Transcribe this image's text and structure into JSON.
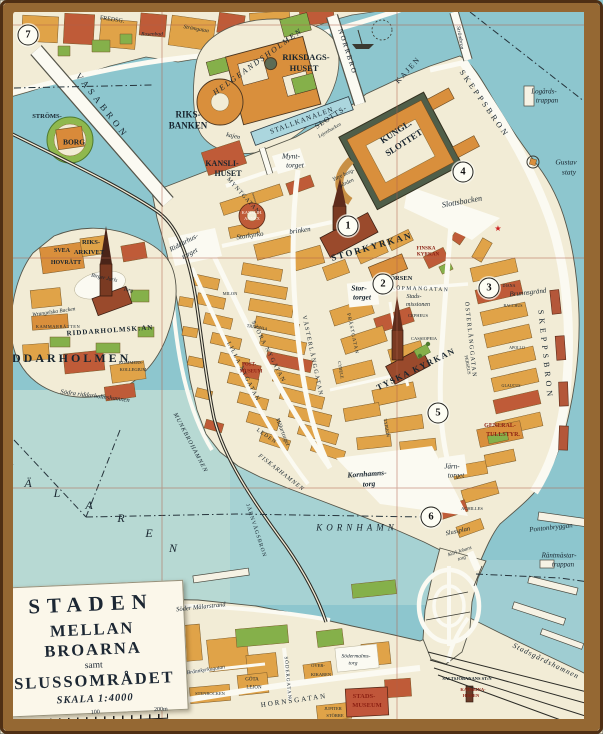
{
  "meta": {
    "map_name": "Staden mellan broarna (Gamla stan, Stockholm) pictorial map"
  },
  "palette": {
    "water": "#8dc6ce",
    "water_light": "#b7d9d3",
    "land": "#f2ecd6",
    "block_orange": "#e0a348",
    "block_orange2": "#d98f3c",
    "block_red": "#bf5b38",
    "church_red": "#9a4a2c",
    "park_green": "#85b04a",
    "roof_dark": "#5c6b55",
    "frame_brown": "#956833",
    "grid_red": "#b0614a",
    "ink": "#17242e",
    "label_red": "#8b1f12"
  },
  "title_block": {
    "line1": "STADEN",
    "line2": "MELLAN BROARNA",
    "line3": "samt",
    "line4": "SLUSSOMRÅDET",
    "scale_label": "SKALA 1:4000",
    "tick_mid": "100",
    "tick_end": "200m"
  },
  "markers": [
    {
      "n": "1",
      "x": 348,
      "y": 226
    },
    {
      "n": "2",
      "x": 383,
      "y": 284
    },
    {
      "n": "3",
      "x": 489,
      "y": 288
    },
    {
      "n": "4",
      "x": 463,
      "y": 172
    },
    {
      "n": "5",
      "x": 438,
      "y": 413
    },
    {
      "n": "6",
      "x": 431,
      "y": 517
    },
    {
      "n": "7",
      "x": 28,
      "y": 35
    }
  ],
  "labels": [
    {
      "t": "FREDSG.",
      "x": 112,
      "y": 20,
      "s": 6,
      "r": 8
    },
    {
      "t": "Rosenbad",
      "x": 152,
      "y": 35,
      "s": 5.5,
      "i": 1
    },
    {
      "t": "Strömgatan",
      "x": 196,
      "y": 30,
      "s": 5.5,
      "i": 1,
      "r": 10
    },
    {
      "t": "VASABRON",
      "x": 102,
      "y": 106,
      "s": 9,
      "r": 52,
      "ls": 4
    },
    {
      "t": "STRÖMS-",
      "x": 47,
      "y": 117,
      "s": 6.5,
      "w": 1
    },
    {
      "t": "BORG",
      "x": 74,
      "y": 142,
      "s": 7.5,
      "w": 1
    },
    {
      "t": "HELGEANDSHOLMEN",
      "x": 258,
      "y": 62,
      "s": 8,
      "r": -36,
      "ls": 2,
      "i": 1
    },
    {
      "t": "RIKSDAGS-",
      "x": 306,
      "y": 57,
      "s": 8.5,
      "w": 1
    },
    {
      "t": "HUSET",
      "x": 304,
      "y": 68,
      "s": 8.5,
      "w": 1
    },
    {
      "t": "RIKS-",
      "x": 188,
      "y": 115,
      "s": 9,
      "w": 1
    },
    {
      "t": "BANKEN",
      "x": 188,
      "y": 126,
      "s": 9,
      "w": 1
    },
    {
      "t": "kajen",
      "x": 233,
      "y": 137,
      "s": 6.5,
      "i": 1,
      "r": 12
    },
    {
      "t": "NORRBRO",
      "x": 347,
      "y": 52,
      "s": 7,
      "r": 72,
      "ls": 2
    },
    {
      "t": "Strömbron",
      "x": 459,
      "y": 38,
      "s": 5.5,
      "i": 1,
      "r": 80
    },
    {
      "t": "STALLKANALEN",
      "x": 302,
      "y": 121,
      "s": 7,
      "r": -20,
      "ls": 1
    },
    {
      "t": "SLOTTS-",
      "x": 331,
      "y": 117,
      "s": 7.5,
      "r": -33,
      "ls": 1
    },
    {
      "t": "KAJEN",
      "x": 408,
      "y": 70,
      "s": 7.5,
      "r": -48,
      "ls": 2
    },
    {
      "t": "SKEPPSBRON",
      "x": 484,
      "y": 104,
      "s": 8,
      "r": 55,
      "ls": 3
    },
    {
      "t": "Logårds-",
      "x": 544,
      "y": 92,
      "s": 7,
      "i": 1
    },
    {
      "t": "trappan",
      "x": 547,
      "y": 101,
      "s": 7,
      "i": 1
    },
    {
      "t": "Gustav",
      "x": 566,
      "y": 162,
      "s": 7.5,
      "i": 1
    },
    {
      "t": "staty",
      "x": 569,
      "y": 172,
      "s": 7.5,
      "i": 1
    },
    {
      "t": "KUNGL.",
      "x": 396,
      "y": 132,
      "s": 9,
      "w": 1,
      "r": -33
    },
    {
      "t": "SLOTTET",
      "x": 404,
      "y": 143,
      "s": 9,
      "w": 1,
      "r": -33
    },
    {
      "t": "Lejonbacken",
      "x": 330,
      "y": 131,
      "s": 5,
      "i": 1,
      "r": -30
    },
    {
      "t": "Yttre borg-",
      "x": 344,
      "y": 176,
      "s": 5.5,
      "i": 1,
      "r": -25
    },
    {
      "t": "gården",
      "x": 347,
      "y": 184,
      "s": 5.5,
      "i": 1,
      "r": -25
    },
    {
      "t": "Mynt-",
      "x": 291,
      "y": 156,
      "s": 7.5,
      "i": 1
    },
    {
      "t": "torget",
      "x": 295,
      "y": 165,
      "s": 7.5,
      "i": 1
    },
    {
      "t": "KANSLI-",
      "x": 222,
      "y": 164,
      "s": 8,
      "w": 1
    },
    {
      "t": "HUSET",
      "x": 228,
      "y": 174,
      "s": 8,
      "w": 1
    },
    {
      "t": "MYNTGATAN",
      "x": 243,
      "y": 196,
      "s": 6,
      "r": 48,
      "ls": 1
    },
    {
      "t": "KANSLIH.",
      "x": 252,
      "y": 213,
      "s": 4.5,
      "c": "#fff6ee"
    },
    {
      "t": "ANNEX",
      "x": 252,
      "y": 219,
      "s": 4.5,
      "c": "#fff6ee"
    },
    {
      "t": "Storkyrko",
      "x": 250,
      "y": 236,
      "s": 7,
      "i": 1,
      "r": -8
    },
    {
      "t": "brinken",
      "x": 300,
      "y": 231,
      "s": 7,
      "i": 1,
      "r": -8
    },
    {
      "t": "Riddarhus-",
      "x": 184,
      "y": 243,
      "s": 7,
      "i": 1,
      "r": -28
    },
    {
      "t": "torget",
      "x": 190,
      "y": 254,
      "s": 7,
      "i": 1,
      "r": -28
    },
    {
      "t": "Slottsbacken",
      "x": 462,
      "y": 202,
      "s": 8,
      "i": 1,
      "r": -10
    },
    {
      "t": "STORKYRKAN",
      "x": 372,
      "y": 247,
      "s": 9,
      "w": 1,
      "r": -16,
      "ls": 2
    },
    {
      "t": "FINSKA",
      "x": 426,
      "y": 249,
      "s": 5,
      "w": 1,
      "c": "#8b1f12"
    },
    {
      "t": "KYRKAN",
      "x": 428,
      "y": 255,
      "s": 5,
      "w": 1,
      "c": "#8b1f12"
    },
    {
      "t": "★",
      "x": 498,
      "y": 229,
      "s": 8,
      "c": "#cc2020"
    },
    {
      "t": "BÖRSEN",
      "x": 399,
      "y": 279,
      "s": 6.5,
      "w": 1
    },
    {
      "t": "Stor-",
      "x": 359,
      "y": 288,
      "s": 7.5,
      "i": 1,
      "w": 1
    },
    {
      "t": "torget",
      "x": 362,
      "y": 297,
      "s": 7.5,
      "i": 1,
      "w": 1
    },
    {
      "t": "KÖPMANGATAN",
      "x": 420,
      "y": 290,
      "s": 5.5,
      "ls": 1.5,
      "r": 2
    },
    {
      "t": "Brunnsgränd",
      "x": 528,
      "y": 293,
      "s": 7,
      "i": 1,
      "r": -6
    },
    {
      "t": "Stads-",
      "x": 414,
      "y": 297,
      "s": 6,
      "i": 1
    },
    {
      "t": "missionen",
      "x": 418,
      "y": 305,
      "s": 6,
      "i": 1
    },
    {
      "t": "CEPHEUS",
      "x": 418,
      "y": 316,
      "s": 4.5
    },
    {
      "t": "CASSIOPEIA",
      "x": 424,
      "y": 339,
      "s": 4.5
    },
    {
      "t": "DIANA",
      "x": 509,
      "y": 286,
      "s": 4
    },
    {
      "t": "BACCHUS",
      "x": 513,
      "y": 306,
      "s": 4
    },
    {
      "t": "APOLLO",
      "x": 517,
      "y": 348,
      "s": 4
    },
    {
      "t": "GLAUCUS",
      "x": 511,
      "y": 386,
      "s": 4
    },
    {
      "t": "PERSEUS",
      "x": 467,
      "y": 365,
      "s": 4.5,
      "r": 80
    },
    {
      "t": "MILON",
      "x": 230,
      "y": 294,
      "s": 4.5
    },
    {
      "t": "TRITONIA",
      "x": 257,
      "y": 328,
      "s": 4.5,
      "r": 10
    },
    {
      "t": "CYBELE",
      "x": 340,
      "y": 370,
      "s": 4.5,
      "r": 80
    },
    {
      "t": "TYPHON",
      "x": 386,
      "y": 428,
      "s": 4.5,
      "r": 80
    },
    {
      "t": "ACHILLES",
      "x": 472,
      "y": 509,
      "s": 4.5
    },
    {
      "t": "VÄSTERLÅNGGATAN",
      "x": 312,
      "y": 356,
      "s": 6,
      "r": 78,
      "ls": 1.5
    },
    {
      "t": "PRÄSTGATAN",
      "x": 352,
      "y": 334,
      "s": 5,
      "r": 78,
      "ls": 1
    },
    {
      "t": "STORA NYGATAN",
      "x": 268,
      "y": 352,
      "s": 6,
      "r": 63,
      "ls": 1.5
    },
    {
      "t": "LILLA NYGATAN",
      "x": 243,
      "y": 372,
      "s": 6,
      "r": 63,
      "ls": 1.5
    },
    {
      "t": "ÖSTERLÅNGGATAN",
      "x": 470,
      "y": 340,
      "s": 6,
      "r": 84,
      "ls": 1.5
    },
    {
      "t": "SKEPPSBRON",
      "x": 545,
      "y": 355,
      "s": 8,
      "r": 84,
      "ls": 4
    },
    {
      "t": "TYSKA KYRKAN",
      "x": 416,
      "y": 369,
      "s": 8.5,
      "w": 1,
      "r": -26,
      "ls": 1.5
    },
    {
      "t": "POST-",
      "x": 249,
      "y": 365,
      "s": 5,
      "w": 1,
      "c": "#8b1f12"
    },
    {
      "t": "MUSEUM",
      "x": 251,
      "y": 372,
      "s": 5,
      "w": 1,
      "c": "#8b1f12"
    },
    {
      "t": "GENERAL-",
      "x": 500,
      "y": 426,
      "s": 6,
      "w": 1,
      "c": "#8b1f12"
    },
    {
      "t": "TULLSTYR.",
      "x": 503,
      "y": 435,
      "s": 6,
      "w": 1,
      "c": "#8b1f12"
    },
    {
      "t": "Järn-",
      "x": 452,
      "y": 467,
      "s": 7,
      "i": 1
    },
    {
      "t": "torget",
      "x": 456,
      "y": 476,
      "s": 7,
      "i": 1
    },
    {
      "t": "Kornhamns-",
      "x": 367,
      "y": 474,
      "s": 7.5,
      "i": 1,
      "w": 1,
      "r": -4
    },
    {
      "t": "torg",
      "x": 369,
      "y": 484,
      "s": 7.5,
      "i": 1,
      "w": 1,
      "r": -4
    },
    {
      "t": "Mälartorget",
      "x": 282,
      "y": 432,
      "s": 6,
      "i": 1,
      "r": 68
    },
    {
      "t": "LEDEN",
      "x": 266,
      "y": 437,
      "s": 5.5,
      "r": 35,
      "ls": 1
    },
    {
      "t": "FISKARHAMNEN",
      "x": 281,
      "y": 473,
      "s": 6,
      "i": 1,
      "r": 38,
      "ls": 1
    },
    {
      "t": "KORNHAMN",
      "x": 357,
      "y": 528,
      "s": 9,
      "i": 1,
      "ls": 4
    },
    {
      "t": "MUNKBROHAMNEN",
      "x": 190,
      "y": 443,
      "s": 6,
      "i": 1,
      "r": 62,
      "ls": 1
    },
    {
      "t": "JÄRNVÄGSBRON",
      "x": 255,
      "y": 531,
      "s": 5.5,
      "r": 72,
      "ls": 1
    },
    {
      "t": "RIDDARHOLMEN",
      "x": 62,
      "y": 358,
      "s": 12,
      "w": 1,
      "ls": 3
    },
    {
      "t": "RIDDARHOLMSK:AN",
      "x": 110,
      "y": 331,
      "s": 7,
      "w": 1,
      "ls": 1,
      "r": -4
    },
    {
      "t": "Wrangelska Backen",
      "x": 54,
      "y": 313,
      "s": 5.5,
      "i": 1,
      "r": -8
    },
    {
      "t": "KAMMARRÄTTEN",
      "x": 58,
      "y": 327,
      "s": 4.5,
      "ls": 0.5
    },
    {
      "t": "SVEA",
      "x": 62,
      "y": 251,
      "s": 6,
      "w": 1
    },
    {
      "t": "HOVRÄTT",
      "x": 66,
      "y": 263,
      "s": 6,
      "w": 1
    },
    {
      "t": "RIKS-",
      "x": 91,
      "y": 243,
      "s": 6.5,
      "w": 1
    },
    {
      "t": "ARKIVET",
      "x": 89,
      "y": 253,
      "s": 6.5,
      "w": 1
    },
    {
      "t": "Birger Jarls",
      "x": 104,
      "y": 279,
      "s": 5.5,
      "i": 1,
      "r": 12
    },
    {
      "t": "Torg",
      "x": 128,
      "y": 291,
      "s": 5.5,
      "i": 1,
      "r": 12
    },
    {
      "t": "KOMMERS-",
      "x": 131,
      "y": 363,
      "s": 4.5
    },
    {
      "t": "KOLLEGIUM",
      "x": 133,
      "y": 370,
      "s": 4.5
    },
    {
      "t": "Södra riddarholmshamnen",
      "x": 95,
      "y": 397,
      "s": 6.5,
      "i": 1,
      "r": 7
    },
    {
      "t": "M",
      "x": 8,
      "y": 468,
      "s": 12,
      "i": 1
    },
    {
      "t": "Ä",
      "x": 28,
      "y": 483,
      "s": 12,
      "i": 1
    },
    {
      "t": "L",
      "x": 57,
      "y": 493,
      "s": 12,
      "i": 1
    },
    {
      "t": "A",
      "x": 89,
      "y": 505,
      "s": 12,
      "i": 1
    },
    {
      "t": "R",
      "x": 121,
      "y": 518,
      "s": 12,
      "i": 1
    },
    {
      "t": "E",
      "x": 149,
      "y": 533,
      "s": 12,
      "i": 1
    },
    {
      "t": "N",
      "x": 173,
      "y": 548,
      "s": 12,
      "i": 1
    },
    {
      "t": "Slussplan",
      "x": 458,
      "y": 532,
      "s": 6.5,
      "i": 1,
      "r": -12
    },
    {
      "t": "Karl Johans",
      "x": 460,
      "y": 552,
      "s": 5,
      "i": 1,
      "r": -18
    },
    {
      "t": "torg",
      "x": 462,
      "y": 559,
      "s": 5,
      "i": 1,
      "r": -18
    },
    {
      "t": "Pontonbryggan",
      "x": 551,
      "y": 528,
      "s": 7,
      "i": 1,
      "r": -6
    },
    {
      "t": "Räntmästar-",
      "x": 559,
      "y": 556,
      "s": 7,
      "i": 1
    },
    {
      "t": "trappan",
      "x": 563,
      "y": 565,
      "s": 7,
      "i": 1
    },
    {
      "t": "Stadsgårdshamnen",
      "x": 546,
      "y": 661,
      "s": 7.5,
      "i": 1,
      "r": 26,
      "ls": 1
    },
    {
      "t": "SALTSJÖBANANS ST:N",
      "x": 467,
      "y": 679,
      "s": 4.5,
      "w": 1
    },
    {
      "t": "KATARINA-",
      "x": 473,
      "y": 690,
      "s": 4.5,
      "w": 1,
      "c": "#8b1f12"
    },
    {
      "t": "HISSEN",
      "x": 471,
      "y": 696,
      "s": 4.5,
      "w": 1,
      "c": "#8b1f12"
    },
    {
      "t": "Södermalms-",
      "x": 356,
      "y": 657,
      "s": 5.5,
      "i": 1
    },
    {
      "t": "torg",
      "x": 353,
      "y": 664,
      "s": 5.5,
      "i": 1
    },
    {
      "t": "STADS-",
      "x": 364,
      "y": 697,
      "s": 6.5,
      "w": 1,
      "c": "#8b1f12"
    },
    {
      "t": "MUSEUM",
      "x": 367,
      "y": 706,
      "s": 6.5,
      "w": 1,
      "c": "#8b1f12"
    },
    {
      "t": "HORNSGATAN",
      "x": 294,
      "y": 701,
      "s": 7,
      "ls": 2,
      "r": -8
    },
    {
      "t": "Brännkyrkagatan",
      "x": 206,
      "y": 671,
      "s": 5.5,
      "i": 1,
      "r": -9
    },
    {
      "t": "Söder Mälarstrand",
      "x": 201,
      "y": 608,
      "s": 6.5,
      "i": 1,
      "r": -6
    },
    {
      "t": "SÖDERGATAN",
      "x": 287,
      "y": 678,
      "s": 5,
      "r": 85,
      "ls": 1
    },
    {
      "t": "GÖTA",
      "x": 252,
      "y": 680,
      "s": 5
    },
    {
      "t": "LEJON",
      "x": 254,
      "y": 688,
      "s": 5
    },
    {
      "t": "STENBOCKEN",
      "x": 210,
      "y": 694,
      "s": 4.5
    },
    {
      "t": "ÖVER-",
      "x": 318,
      "y": 666,
      "s": 4.5
    },
    {
      "t": "KIKAREN",
      "x": 321,
      "y": 675,
      "s": 4.5
    },
    {
      "t": "JUPITER",
      "x": 333,
      "y": 709,
      "s": 4.5
    },
    {
      "t": "STÖRRE",
      "x": 335,
      "y": 716,
      "s": 4.5
    }
  ]
}
